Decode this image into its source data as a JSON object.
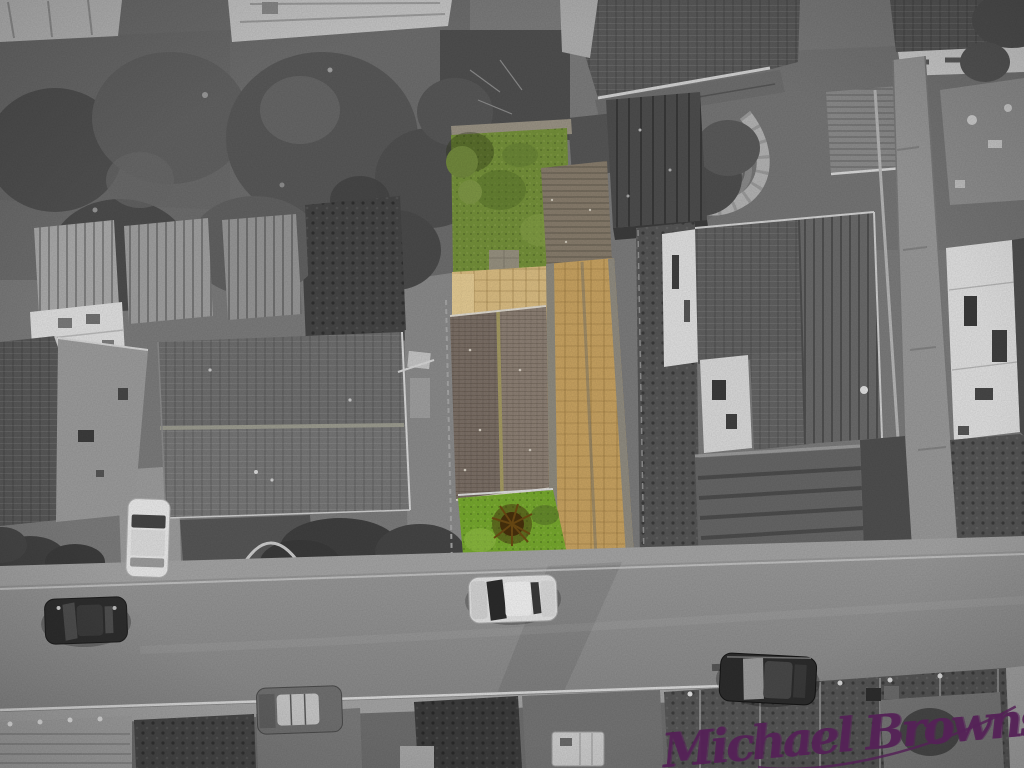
{
  "watermark": {
    "text": "Michael Brownsett",
    "color": "#552257"
  },
  "palette": {
    "lawn_top": "#74903a",
    "lawn_bottom": "#76a82e",
    "lawn_shadow": "#55702a",
    "paving_tan": "#c7a261",
    "patio_tan": "#d9bc82",
    "roof_left": "#7b6f66",
    "roof_right": "#8c7f74",
    "ridge_moss": "#a49a62",
    "shed_brown": "#877c6c",
    "bush_brown": "#47300c",
    "signature": "#552257",
    "road_gray": "#8e8e8e",
    "sidewalk_gray": "#a3a3a3",
    "ground_gray": "#7b7b7b",
    "garden_dark": "#5f5f5f",
    "tree_dark": "#505050",
    "tree_mid": "#616161",
    "roof_dark": "#585858",
    "roof_mid": "#6e6e6e",
    "wall_white": "#dfdfdf"
  }
}
